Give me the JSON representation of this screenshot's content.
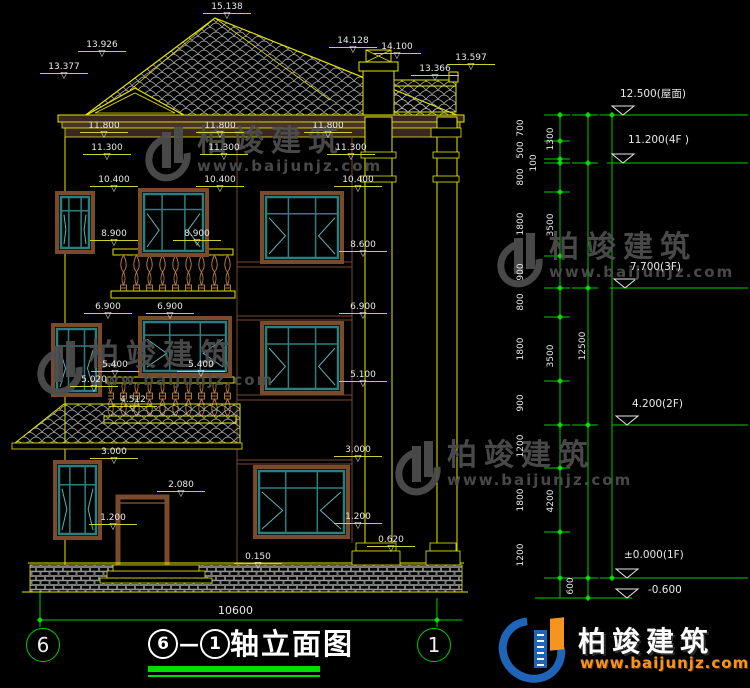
{
  "colors": {
    "background": "#000000",
    "cad_yellow": "#e6e600",
    "cad_green": "#00cc00",
    "cad_white": "#e8e8e8",
    "window_teal": "#2a8080",
    "frame_brown": "#7a4a2a",
    "baluster_orange": "#c08040",
    "watermark_gray": "#4f4f4f",
    "logo_blue": "#1e64b8",
    "logo_orange": "#f5941e",
    "title_underline_green": "#00dd00"
  },
  "watermark": {
    "brand": "柏竣建筑",
    "url": "www.baijunjz.com",
    "instances": [
      {
        "x": 146,
        "y": 126
      },
      {
        "x": 498,
        "y": 232
      },
      {
        "x": 38,
        "y": 340
      },
      {
        "x": 396,
        "y": 440
      }
    ]
  },
  "logo": {
    "brand": "柏竣建筑",
    "url": "www.baijunjz.com"
  },
  "title": {
    "axis_start": "6",
    "separator": "—",
    "axis_end": "1",
    "name": "轴立面图"
  },
  "axis_bubbles": {
    "left": "6",
    "right": "1"
  },
  "annotations": [
    {
      "text": "15.138",
      "x": 203,
      "y": 2,
      "kind": "dim"
    },
    {
      "text": "13.926",
      "x": 78,
      "y": 40,
      "kind": "dim"
    },
    {
      "text": "13.377",
      "x": 40,
      "y": 62,
      "kind": "dim"
    },
    {
      "text": "14.128",
      "x": 329,
      "y": 36,
      "kind": "dim"
    },
    {
      "text": "14.100",
      "x": 373,
      "y": 42,
      "kind": "dim"
    },
    {
      "text": "13.366",
      "x": 411,
      "y": 64,
      "kind": "dim"
    },
    {
      "text": "13.597",
      "x": 447,
      "y": 53,
      "kind": "dim"
    },
    {
      "text": "11.800",
      "x": 80,
      "y": 121,
      "kind": "dim"
    },
    {
      "text": "11.800",
      "x": 196,
      "y": 121,
      "kind": "dim"
    },
    {
      "text": "11.800",
      "x": 304,
      "y": 121,
      "kind": "dim"
    },
    {
      "text": "11.300",
      "x": 83,
      "y": 143,
      "kind": "dim"
    },
    {
      "text": "11.300",
      "x": 200,
      "y": 143,
      "kind": "dim"
    },
    {
      "text": "11.300",
      "x": 327,
      "y": 143,
      "kind": "dim"
    },
    {
      "text": "10.400",
      "x": 90,
      "y": 175,
      "kind": "dim"
    },
    {
      "text": "10.400",
      "x": 196,
      "y": 175,
      "kind": "dim"
    },
    {
      "text": "10.400",
      "x": 334,
      "y": 175,
      "kind": "dim"
    },
    {
      "text": "8.900",
      "x": 90,
      "y": 229,
      "kind": "dim"
    },
    {
      "text": "8.900",
      "x": 173,
      "y": 229,
      "kind": "dim"
    },
    {
      "text": "8.600",
      "x": 339,
      "y": 240,
      "kind": "dim"
    },
    {
      "text": "6.900",
      "x": 84,
      "y": 302,
      "kind": "dim"
    },
    {
      "text": "6.900",
      "x": 146,
      "y": 302,
      "kind": "dim"
    },
    {
      "text": "6.900",
      "x": 339,
      "y": 302,
      "kind": "dim"
    },
    {
      "text": "5.400",
      "x": 91,
      "y": 360,
      "kind": "dim"
    },
    {
      "text": "5.400",
      "x": 177,
      "y": 360,
      "kind": "dim"
    },
    {
      "text": "5.100",
      "x": 339,
      "y": 370,
      "kind": "dim"
    },
    {
      "text": "5.020",
      "x": 70,
      "y": 375,
      "kind": "dim"
    },
    {
      "text": "4.512",
      "x": 109,
      "y": 395,
      "kind": "dim"
    },
    {
      "text": "3.000",
      "x": 90,
      "y": 447,
      "kind": "dim"
    },
    {
      "text": "3.000",
      "x": 334,
      "y": 445,
      "kind": "dim"
    },
    {
      "text": "2.080",
      "x": 157,
      "y": 480,
      "kind": "dim"
    },
    {
      "text": "1.200",
      "x": 89,
      "y": 513,
      "kind": "dim"
    },
    {
      "text": "1.200",
      "x": 334,
      "y": 512,
      "kind": "dim"
    },
    {
      "text": "0.620",
      "x": 367,
      "y": 535,
      "kind": "dim"
    },
    {
      "text": "0.150",
      "x": 234,
      "y": 552,
      "kind": "dim"
    },
    {
      "text": "10600",
      "x": 218,
      "y": 604,
      "kind": "plain"
    },
    {
      "text": "700",
      "x": 521,
      "y": 128,
      "kind": "rot"
    },
    {
      "text": "500",
      "x": 521,
      "y": 150,
      "kind": "rot"
    },
    {
      "text": "100",
      "x": 534,
      "y": 163,
      "kind": "rot"
    },
    {
      "text": "800",
      "x": 521,
      "y": 177,
      "kind": "rot"
    },
    {
      "text": "1800",
      "x": 521,
      "y": 224,
      "kind": "rot"
    },
    {
      "text": "900",
      "x": 521,
      "y": 272,
      "kind": "rot"
    },
    {
      "text": "800",
      "x": 521,
      "y": 302,
      "kind": "rot"
    },
    {
      "text": "1800",
      "x": 521,
      "y": 349,
      "kind": "rot"
    },
    {
      "text": "900",
      "x": 521,
      "y": 403,
      "kind": "rot"
    },
    {
      "text": "1200",
      "x": 521,
      "y": 446,
      "kind": "rot"
    },
    {
      "text": "1800",
      "x": 521,
      "y": 500,
      "kind": "rot"
    },
    {
      "text": "1200",
      "x": 521,
      "y": 555,
      "kind": "rot"
    },
    {
      "text": "1300",
      "x": 551,
      "y": 139,
      "kind": "rot"
    },
    {
      "text": "3500",
      "x": 551,
      "y": 225,
      "kind": "rot"
    },
    {
      "text": "3500",
      "x": 551,
      "y": 356,
      "kind": "rot"
    },
    {
      "text": "4200",
      "x": 551,
      "y": 501,
      "kind": "rot"
    },
    {
      "text": "600",
      "x": 571,
      "y": 586,
      "kind": "rot"
    },
    {
      "text": "12500",
      "x": 583,
      "y": 346,
      "kind": "rot"
    },
    {
      "text": "12.500(屋面)",
      "x": 620,
      "y": 86,
      "kind": "elev"
    },
    {
      "text": "11.200(4F )",
      "x": 628,
      "y": 134,
      "kind": "elev"
    },
    {
      "text": "7.700(3F)",
      "x": 630,
      "y": 261,
      "kind": "elev"
    },
    {
      "text": "4.200(2F)",
      "x": 632,
      "y": 398,
      "kind": "elev"
    },
    {
      "text": "±0.000(1F)",
      "x": 624,
      "y": 549,
      "kind": "elev"
    },
    {
      "text": "-0.600",
      "x": 648,
      "y": 584,
      "kind": "elev"
    }
  ]
}
